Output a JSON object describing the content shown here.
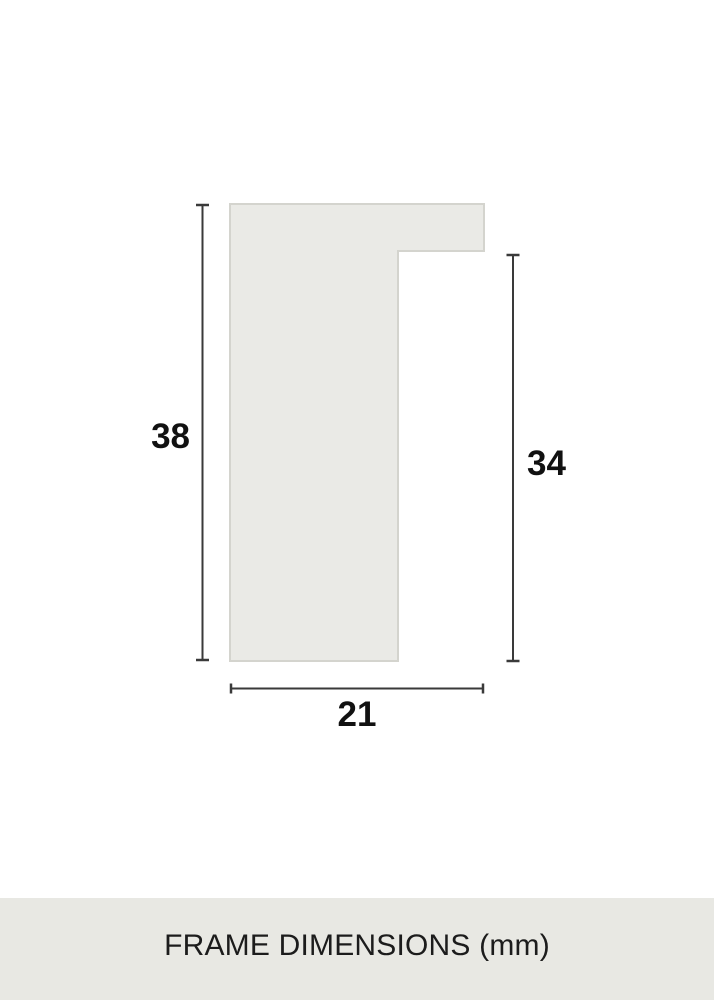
{
  "diagram": {
    "title": "frame-profile-cross-section",
    "dimensions": {
      "frame_height_mm": "38",
      "rabbet_height_mm": "34",
      "frame_width_mm": "21"
    },
    "colors": {
      "profile_fill": "#eaeae6",
      "profile_border": "#d4d4ce",
      "dimension_line": "#3a3a3a",
      "dimension_text": "#111111"
    }
  },
  "footer": {
    "label": "FRAME DIMENSIONS (mm)",
    "background": "#e8e8e3",
    "text_color": "#1c1c1c"
  }
}
